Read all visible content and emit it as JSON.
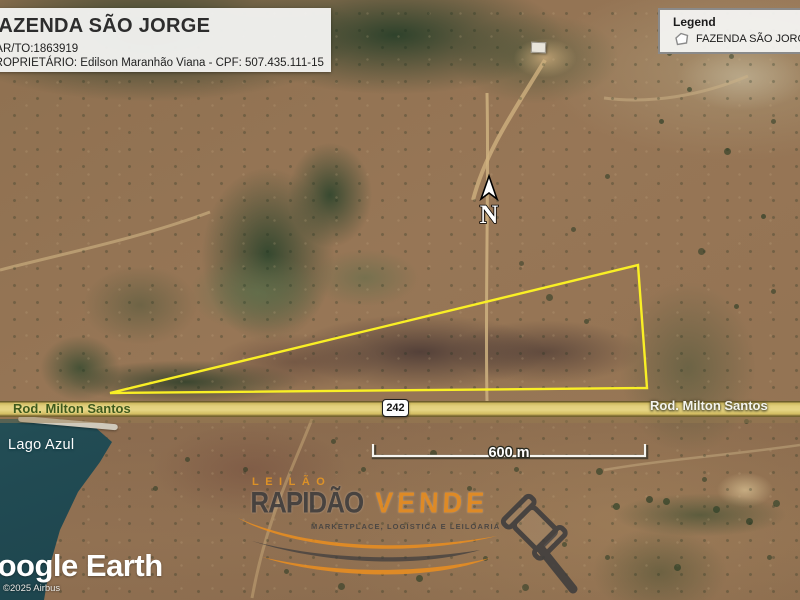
{
  "title_box": {
    "title": "FAZENDA SÃO JORGE",
    "car_line": "CAR/TO:1863919",
    "owner_line": "PROPRIETÁRIO: Edilson Maranhão Viana - CPF: 507.435.111-15"
  },
  "legend": {
    "title": "Legend",
    "items": [
      {
        "icon": "polygon-outline-icon",
        "label": "FAZENDA SÃO JORGE"
      }
    ]
  },
  "map": {
    "north_label": "N",
    "scale_label": "600 m",
    "route_shield": "242",
    "road_label_left": "Rod. Milton Santos",
    "road_label_right": "Rod. Milton Santos",
    "water_label": "Lago Azul",
    "property_outline_color": "#f9ef25"
  },
  "watermark": {
    "line1": "LEILÃO",
    "brand_dark": "RAPIDÃO",
    "brand_orange": "VENDE",
    "tagline": "MARKETPLACE, LOGÍSTICA E LEILOARIA",
    "accent_color": "#ed8f1e",
    "gavel": "gavel-icon"
  },
  "attribution": {
    "logo_text": "Google Earth",
    "copyright": "©2025 Airbus"
  }
}
